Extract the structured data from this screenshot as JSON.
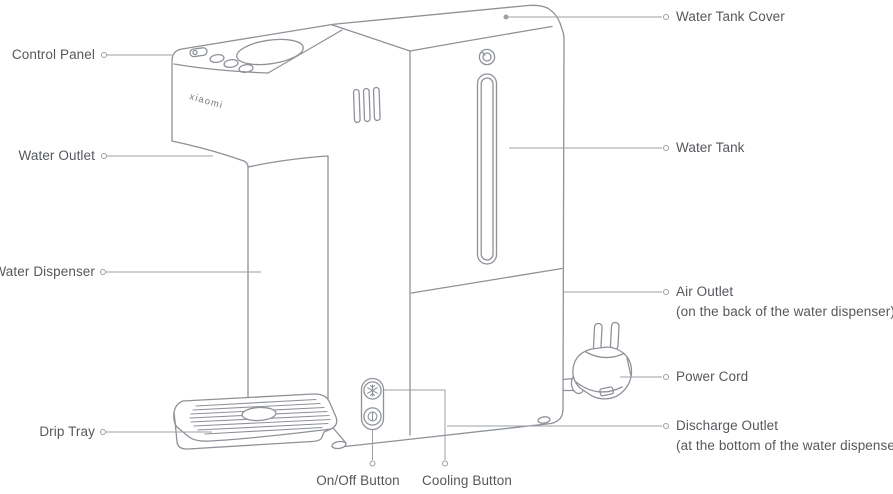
{
  "brand": "xiaomi",
  "labels": {
    "control_panel": "Control Panel",
    "water_outlet": "Water Outlet",
    "water_dispenser": "Water Dispenser",
    "drip_tray": "Drip Tray",
    "water_tank_cover": "Water Tank Cover",
    "water_tank": "Water Tank",
    "air_outlet": "Air Outlet",
    "air_outlet_note": "(on the back of the water dispenser)",
    "power_cord": "Power Cord",
    "discharge_outlet": "Discharge Outlet",
    "discharge_outlet_note": "(at the bottom of the water dispenser)",
    "on_off_button": "On/Off Button",
    "cooling_button": "Cooling Button"
  },
  "icons": {
    "cooling_button": "snowflake-icon",
    "on_off_button": "power-icon",
    "water_tank_top": "lock-icon"
  },
  "colors": {
    "outline": "#8e9298",
    "leader": "#9ba0a6",
    "text": "#55585c",
    "background": "#ffffff"
  }
}
